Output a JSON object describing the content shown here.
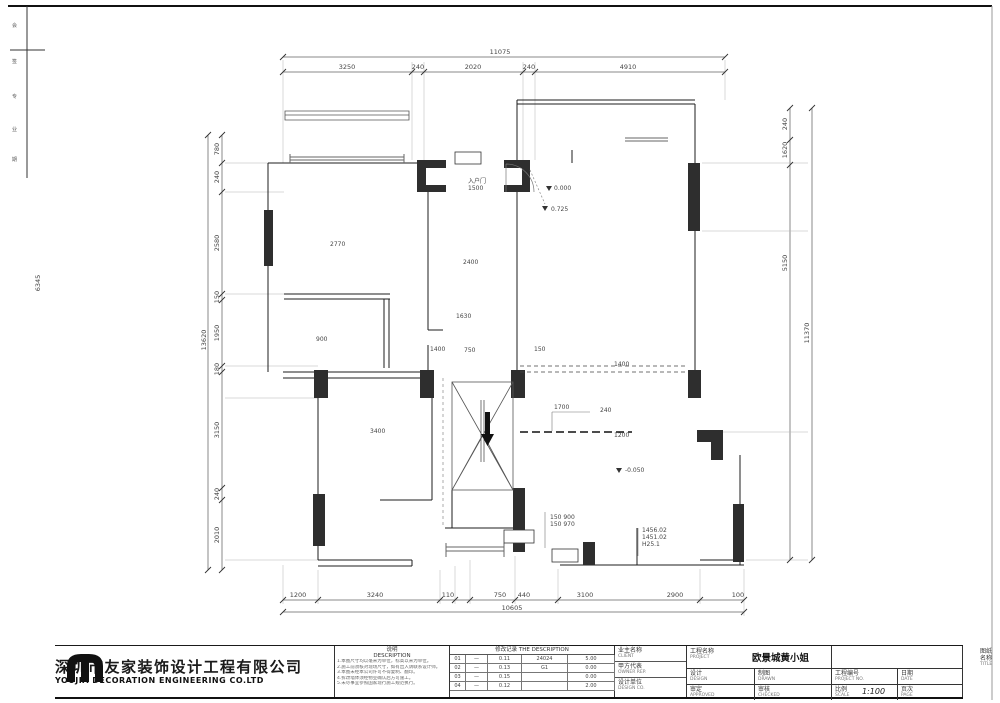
{
  "plan": {
    "dims": {
      "top_total": "11075",
      "top": [
        "3250",
        "240",
        "2020",
        "240",
        "4910"
      ],
      "bottom": [
        "1200",
        "3240",
        "110",
        "750",
        "440",
        "3100",
        "2900",
        "100"
      ],
      "bottom_total": "10605",
      "left_total": "13620",
      "left": [
        "780",
        "240",
        "2580",
        "150",
        "1950",
        "180",
        "3150",
        "240",
        "2010"
      ],
      "right": [
        "240",
        "1620",
        "5150"
      ],
      "right_total": "11370",
      "margin": "6345"
    },
    "ann": {
      "entry1": "入户门",
      "entry2": "1500",
      "lv_a": "0.000",
      "lv_b": "0.725",
      "lv_c": "-0.050",
      "room_a": "2770",
      "room_b": "2400",
      "d1": "1630",
      "d2": "1400",
      "d3": "750",
      "d4": "150",
      "d5": "1400",
      "kitchen": "900",
      "bl": "3400",
      "stair": "1700",
      "r240": "240",
      "r1200": "1200",
      "n1": "150 900",
      "n2": "150 970",
      "b1": "1456.02",
      "b2": "1451.02",
      "b3": "H25.1"
    }
  },
  "titleblock": {
    "company_cn": "深圳市友家装饰设计工程有限公司",
    "company_en": "YOUJIA DECORATION ENGINEERING  CO.LTD",
    "desc": {
      "title_cn": "说明",
      "title_en": "DESCRIPTION",
      "notes": [
        "1.本图尺寸均以毫米为单位，标高以米为单位。",
        "2.施工前须核对现场尺寸，如有出入请联系设计师。",
        "3.本图未经本公司许可不得复制、翻印。",
        "4.拆改墙体须经物业确认后方可施工。",
        "5.未尽事宜参照国家现行施工规范执行。"
      ]
    },
    "table": {
      "title_cn": "修改记录",
      "title_en": "THE DESCRIPTION",
      "rows": [
        [
          "01",
          "—",
          "0.11",
          "24024",
          "5.00"
        ],
        [
          "02",
          "—",
          "0.13",
          "G1",
          "0.00"
        ],
        [
          "03",
          "—",
          "0.15",
          "",
          "0.00"
        ],
        [
          "04",
          "—",
          "0.12",
          "",
          "2.00"
        ]
      ]
    },
    "client": {
      "pairs": [
        [
          "业主名称",
          "CLIENT"
        ],
        [
          "甲方代表",
          "OWNER REP."
        ],
        [
          "设计单位",
          "DESIGN CO."
        ]
      ]
    },
    "project": {
      "label_cn": "工程名称",
      "label_en": "PROJECT",
      "value": "欧景城黄小姐"
    },
    "drawing": {
      "label_cn": "图纸名称",
      "label_en": "TITLE",
      "value": "一楼原始结构图"
    },
    "fields": {
      "row2": [
        {
          "cn": "设计",
          "en": "DESIGN"
        },
        {
          "cn": "制图",
          "en": "DRAWN"
        },
        {
          "cn": "工程编号",
          "en": "PROJECT NO."
        },
        {
          "cn": "日期",
          "en": "DATE"
        }
      ],
      "row3": [
        {
          "cn": "审定",
          "en": "APPROVED"
        },
        {
          "cn": "审核",
          "en": "CHECKED"
        },
        {
          "cn": "比例",
          "en": "SCALE"
        },
        {
          "cn": "页次",
          "en": "PAGE"
        }
      ],
      "scale_value": "1:100"
    },
    "strip_chars": [
      "会",
      "签",
      "专",
      "业",
      "期"
    ]
  }
}
